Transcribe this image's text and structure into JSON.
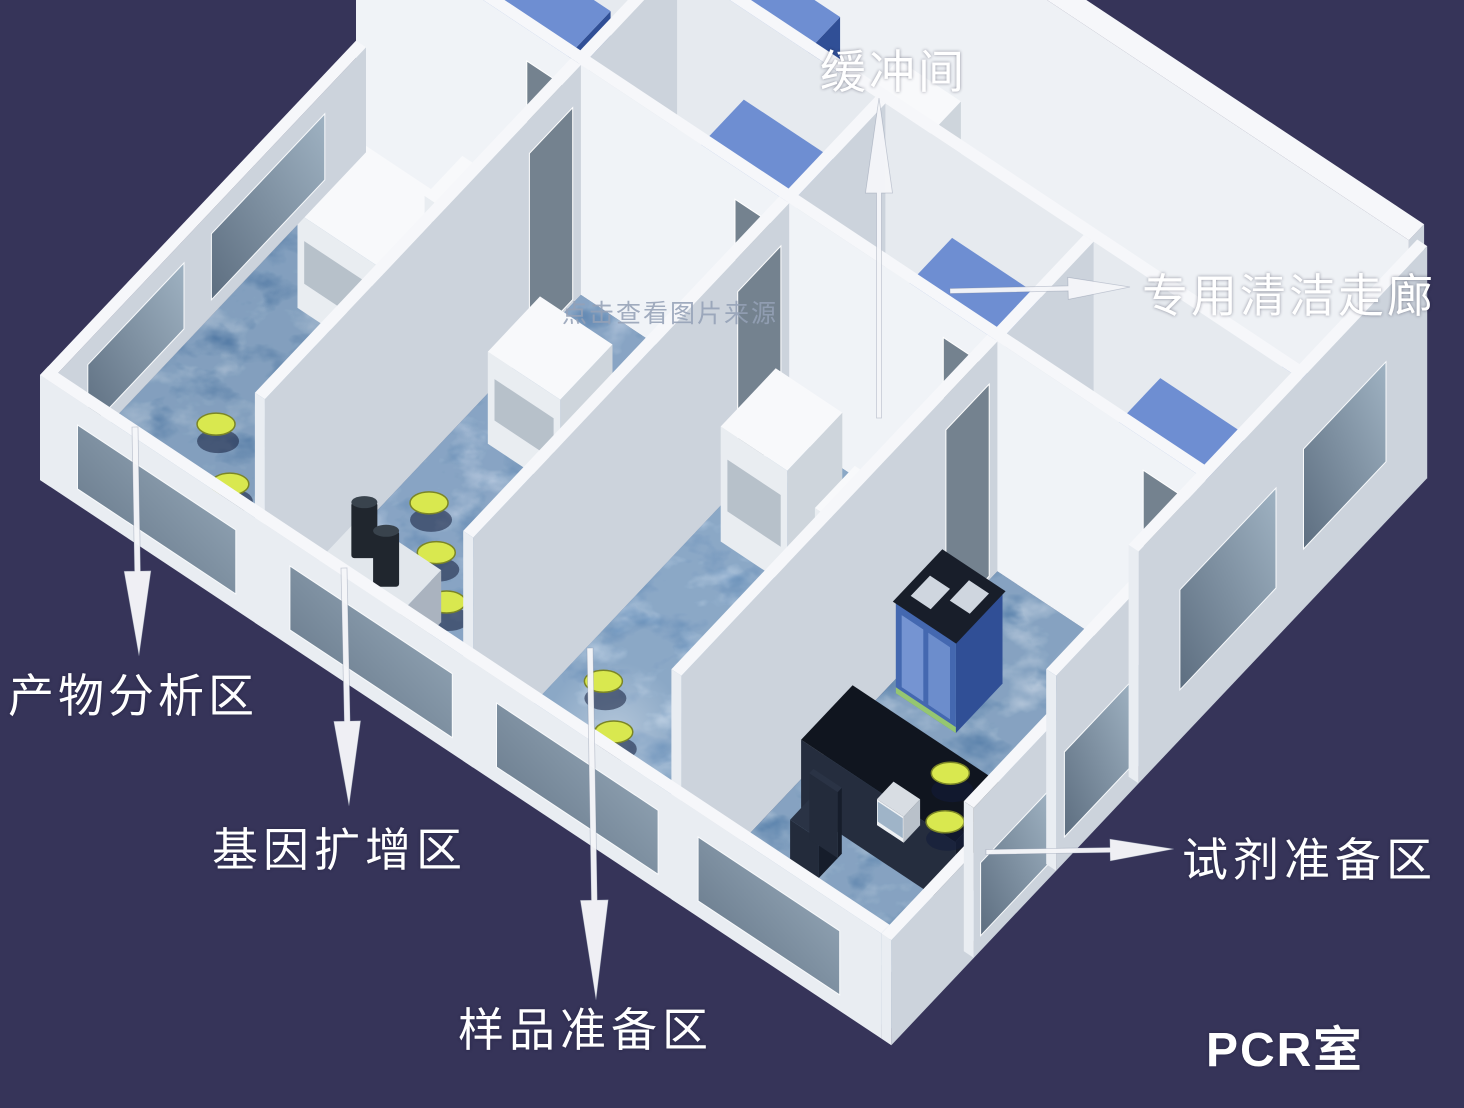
{
  "diagram": {
    "title": "PCR实验室布局示意图",
    "labels": {
      "buffer_room": "缓冲间",
      "clean_corridor": "专用清洁走廊",
      "product_analysis": "产物分析区",
      "gene_amplification": "基因扩增区",
      "sample_preparation": "样品准备区",
      "reagent_preparation": "试剂准备区",
      "pcr_room": "PCR室"
    },
    "watermark": "点击查看图片来源",
    "colors": {
      "background": "#363459",
      "label_text": "#ffffff",
      "arrow_white": "#f5f6f9",
      "watermark_gray": "#94a0b6",
      "wall_top": "#f6f7fa",
      "wall_front": "#e9edf2",
      "wall_side": "#ccd3dc",
      "floor_room1": "#4a729f",
      "floor_room2": "#6189b8",
      "floor_room3": "#6e97c4",
      "floor_room4": "#567fab",
      "floor_buffer": "#9db4cd",
      "floor_corridor": "#8aa6c6",
      "floor_dark_edge": "#1d3a63",
      "cabinet_blue": "#4468b0",
      "cabinet_blue_side": "#304f96",
      "cabinet_blue_top": "#6e8ed2",
      "cabinet_glass": "#7e9cd8",
      "equipment_white": "#e9edf1",
      "bench_black": "#10151f",
      "stool_yellow": "#d9e84f",
      "stool_rim": "#7b8526",
      "glass_dark": "#5d6e80",
      "glass_light": "#9fb2c2",
      "door_gray": "#74828f"
    }
  }
}
